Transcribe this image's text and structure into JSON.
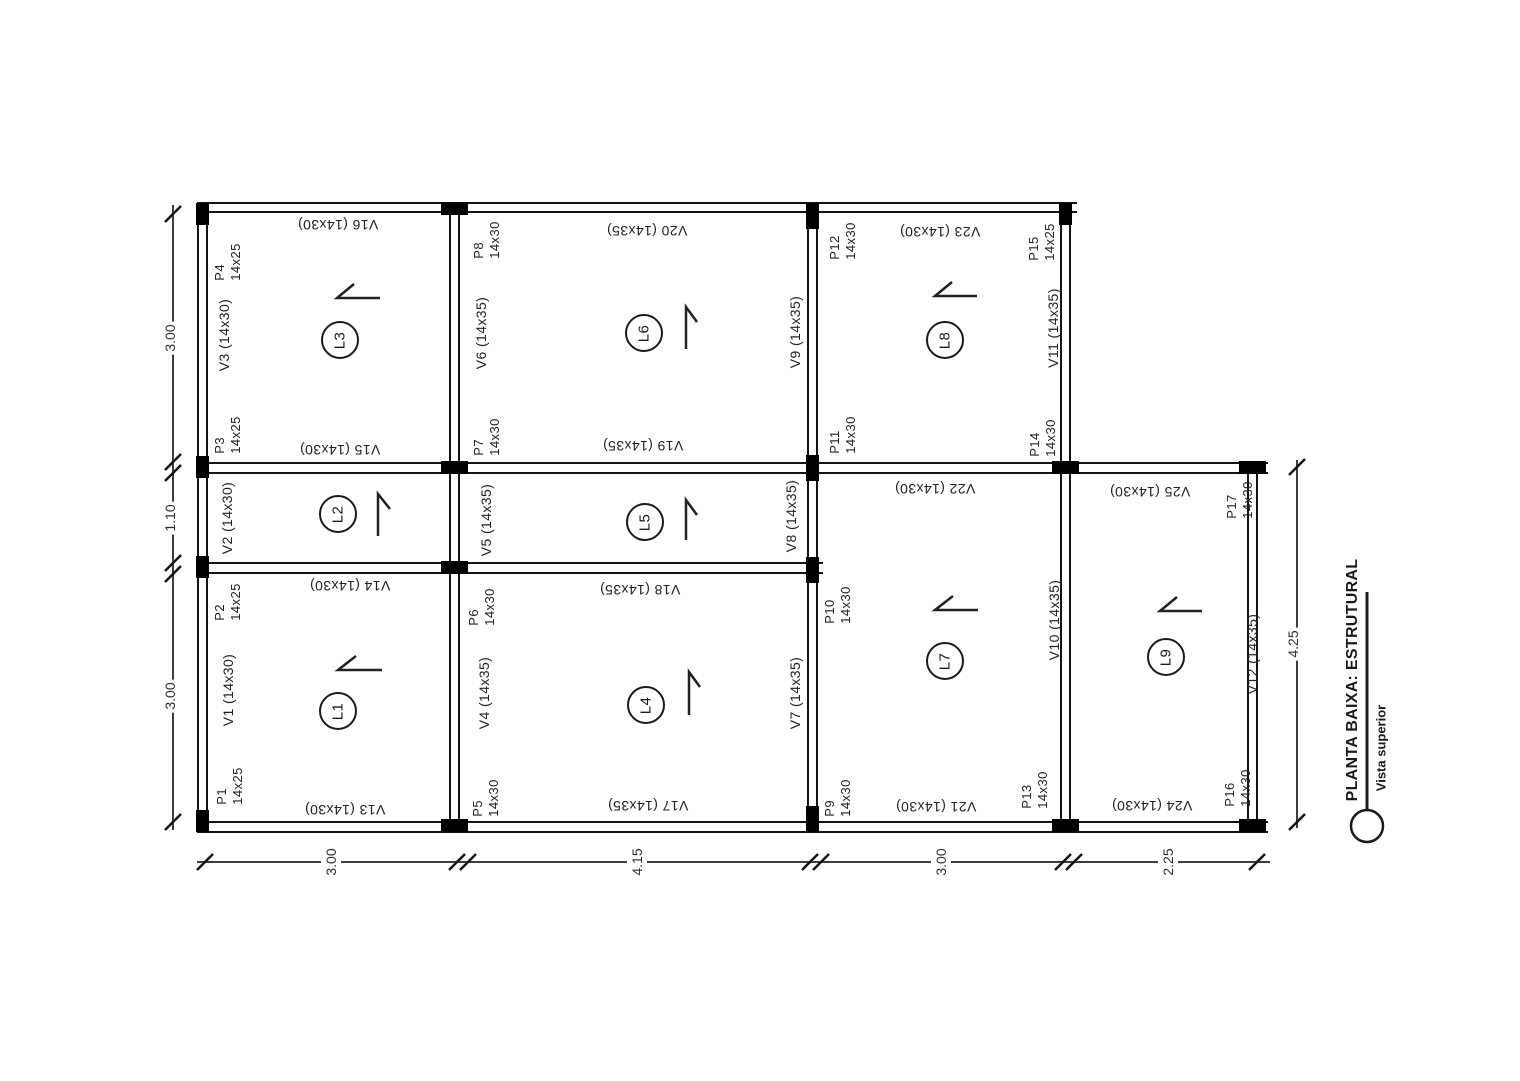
{
  "title": {
    "main": "PLANTA BAIXA: ESTRUTURAL",
    "sub": "Vista superior"
  },
  "slabs": [
    {
      "id": "L1"
    },
    {
      "id": "L2"
    },
    {
      "id": "L3"
    },
    {
      "id": "L4"
    },
    {
      "id": "L5"
    },
    {
      "id": "L6"
    },
    {
      "id": "L7"
    },
    {
      "id": "L8"
    },
    {
      "id": "L9"
    }
  ],
  "columns": [
    {
      "id": "P1",
      "size": "14x25"
    },
    {
      "id": "P2",
      "size": "14x25"
    },
    {
      "id": "P3",
      "size": "14x25"
    },
    {
      "id": "P4",
      "size": "14x25"
    },
    {
      "id": "P5",
      "size": "14x30"
    },
    {
      "id": "P6",
      "size": "14x30"
    },
    {
      "id": "P7",
      "size": "14x30"
    },
    {
      "id": "P8",
      "size": "14x30"
    },
    {
      "id": "P9",
      "size": "14x30"
    },
    {
      "id": "P10",
      "size": "14x30"
    },
    {
      "id": "P11",
      "size": "14x30"
    },
    {
      "id": "P12",
      "size": "14x30"
    },
    {
      "id": "P13",
      "size": "14x30"
    },
    {
      "id": "P14",
      "size": "14x30"
    },
    {
      "id": "P15",
      "size": "14x25"
    },
    {
      "id": "P16",
      "size": "14x30"
    },
    {
      "id": "P17",
      "size": "14x30"
    }
  ],
  "beams": [
    {
      "id": "V1",
      "label": "V1 (14x30)"
    },
    {
      "id": "V2",
      "label": "V2 (14x30)"
    },
    {
      "id": "V3",
      "label": "V3 (14x30)"
    },
    {
      "id": "V4",
      "label": "V4 (14x35)"
    },
    {
      "id": "V5",
      "label": "V5 (14x35)"
    },
    {
      "id": "V6",
      "label": "V6 (14x35)"
    },
    {
      "id": "V7",
      "label": "V7 (14x35)"
    },
    {
      "id": "V8",
      "label": "V8 (14x35)"
    },
    {
      "id": "V9",
      "label": "V9 (14x35)"
    },
    {
      "id": "V10",
      "label": "V10 (14x35)"
    },
    {
      "id": "V11",
      "label": "V11 (14x35)"
    },
    {
      "id": "V12",
      "label": "V12 (14x35)"
    },
    {
      "id": "V13",
      "label": "V13 (14x30)"
    },
    {
      "id": "V14",
      "label": "V14 (14x30)"
    },
    {
      "id": "V15",
      "label": "V15 (14x30)"
    },
    {
      "id": "V16",
      "label": "V16 (14x30)"
    },
    {
      "id": "V17",
      "label": "V17 (14x35)"
    },
    {
      "id": "V18",
      "label": "V18 (14x35)"
    },
    {
      "id": "V19",
      "label": "V19 (14x35)"
    },
    {
      "id": "V20",
      "label": "V20 (14x35)"
    },
    {
      "id": "V21",
      "label": "V21 (14x30)"
    },
    {
      "id": "V22",
      "label": "V22 (14x30)"
    },
    {
      "id": "V23",
      "label": "V23 (14x30)"
    },
    {
      "id": "V24",
      "label": "V24 (14x30)"
    },
    {
      "id": "V25",
      "label": "V25 (14x30)"
    }
  ],
  "dimensions": {
    "left": [
      "3.00",
      "1.10",
      "3.00"
    ],
    "bottom": [
      "3.00",
      "4.15",
      "3.00",
      "2.25"
    ],
    "right": [
      "4.25"
    ]
  }
}
